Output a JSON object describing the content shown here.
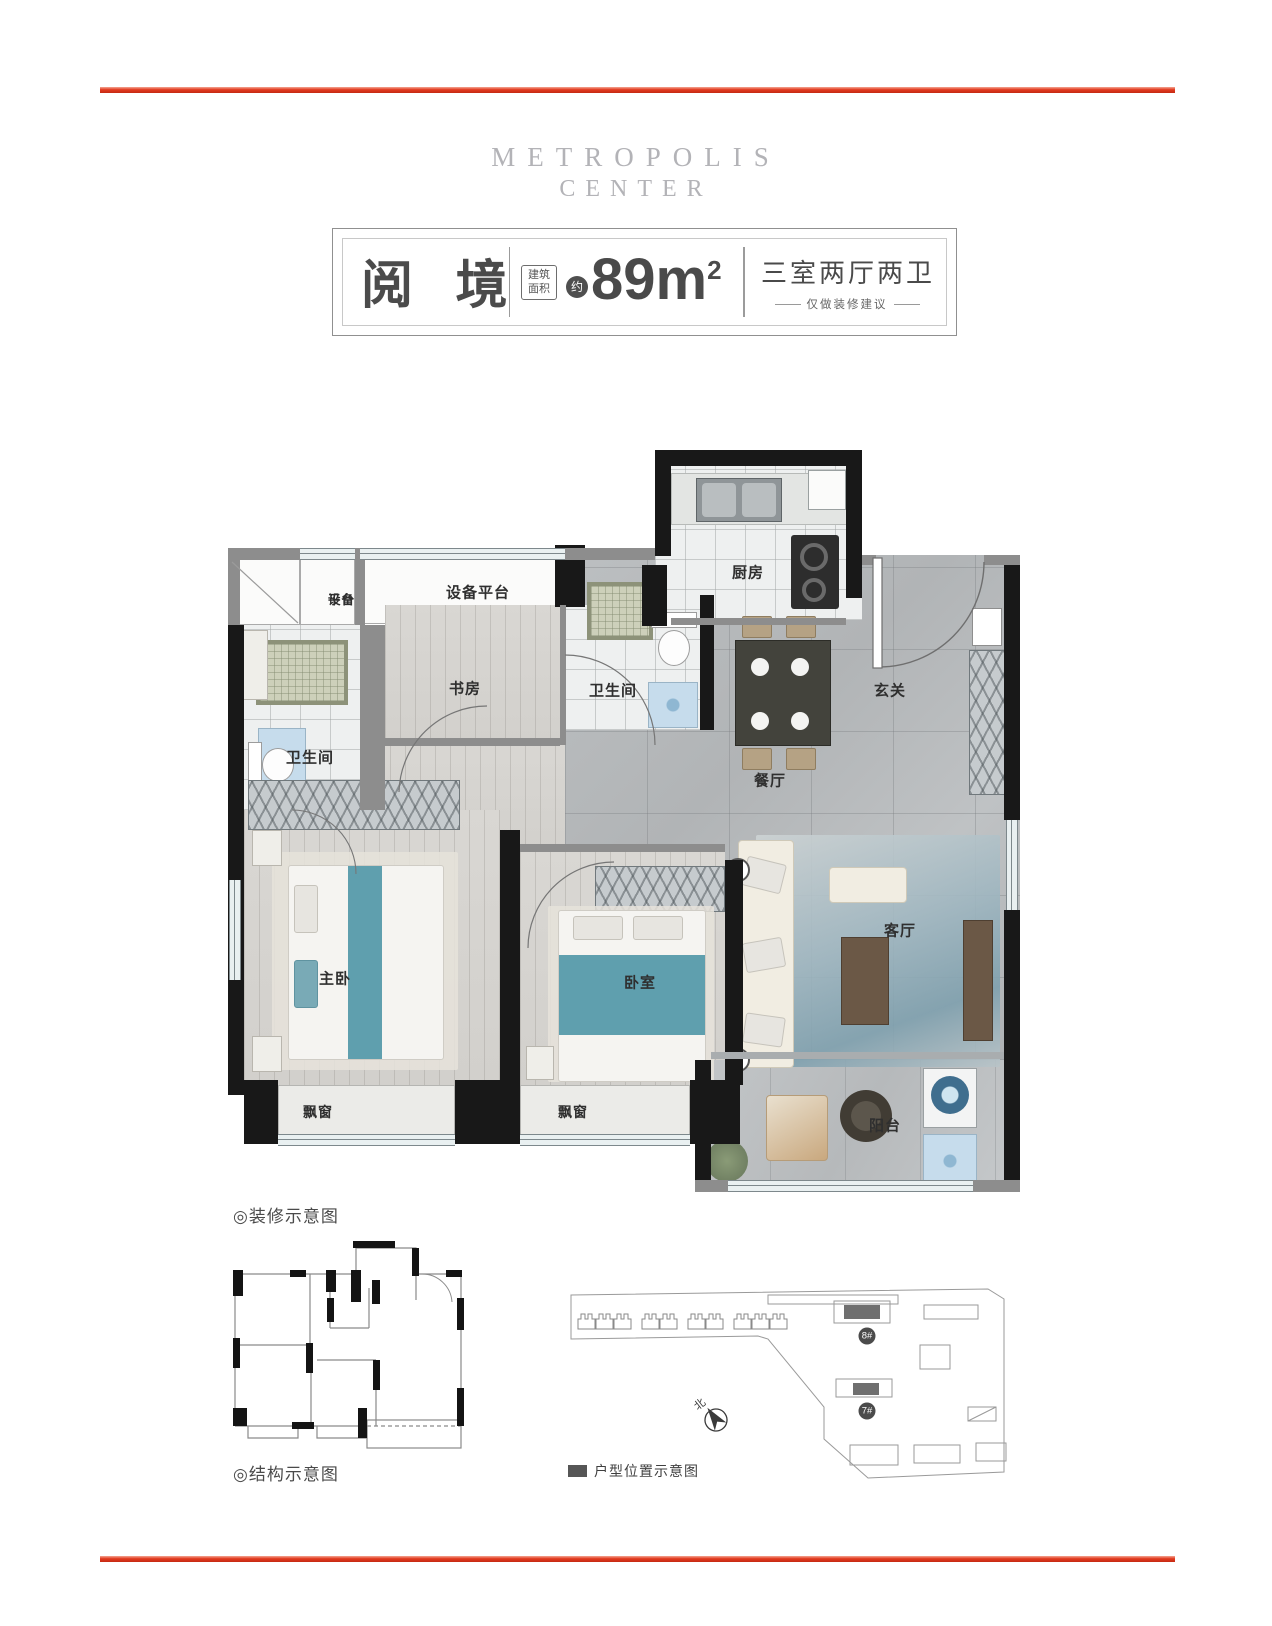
{
  "brand": {
    "line1": "METROPOLIS",
    "line2": "CENTER"
  },
  "title_card": {
    "name": "阅 境",
    "area_label_1": "建筑",
    "area_label_2": "面积",
    "approx": "约",
    "area_value": "89m",
    "area_exp": "2",
    "layout_text": "三室两厅两卫",
    "note": "仅做装修建议"
  },
  "floorplan": {
    "caption": "◎装修示意图",
    "rooms": {
      "equip_small_1": "设备",
      "equip_small_2": "平台",
      "equip_wide": "设备平台",
      "study": "书房",
      "bath_top": "卫生间",
      "bath_left": "卫生间",
      "kitchen": "厨房",
      "foyer": "玄关",
      "dining": "餐厅",
      "master": "主卧",
      "bedroom": "卧室",
      "living": "客厅",
      "bay_1": "飘窗",
      "bay_2": "飘窗",
      "balcony": "阳台"
    }
  },
  "structure": {
    "caption": "◎结构示意图"
  },
  "siteplan": {
    "legend": "户型位置示意图",
    "north": "北",
    "badge_8": "8#",
    "badge_7": "7#"
  },
  "colors": {
    "accent_red": "#e23a1f",
    "teal": "#5f9fae"
  }
}
